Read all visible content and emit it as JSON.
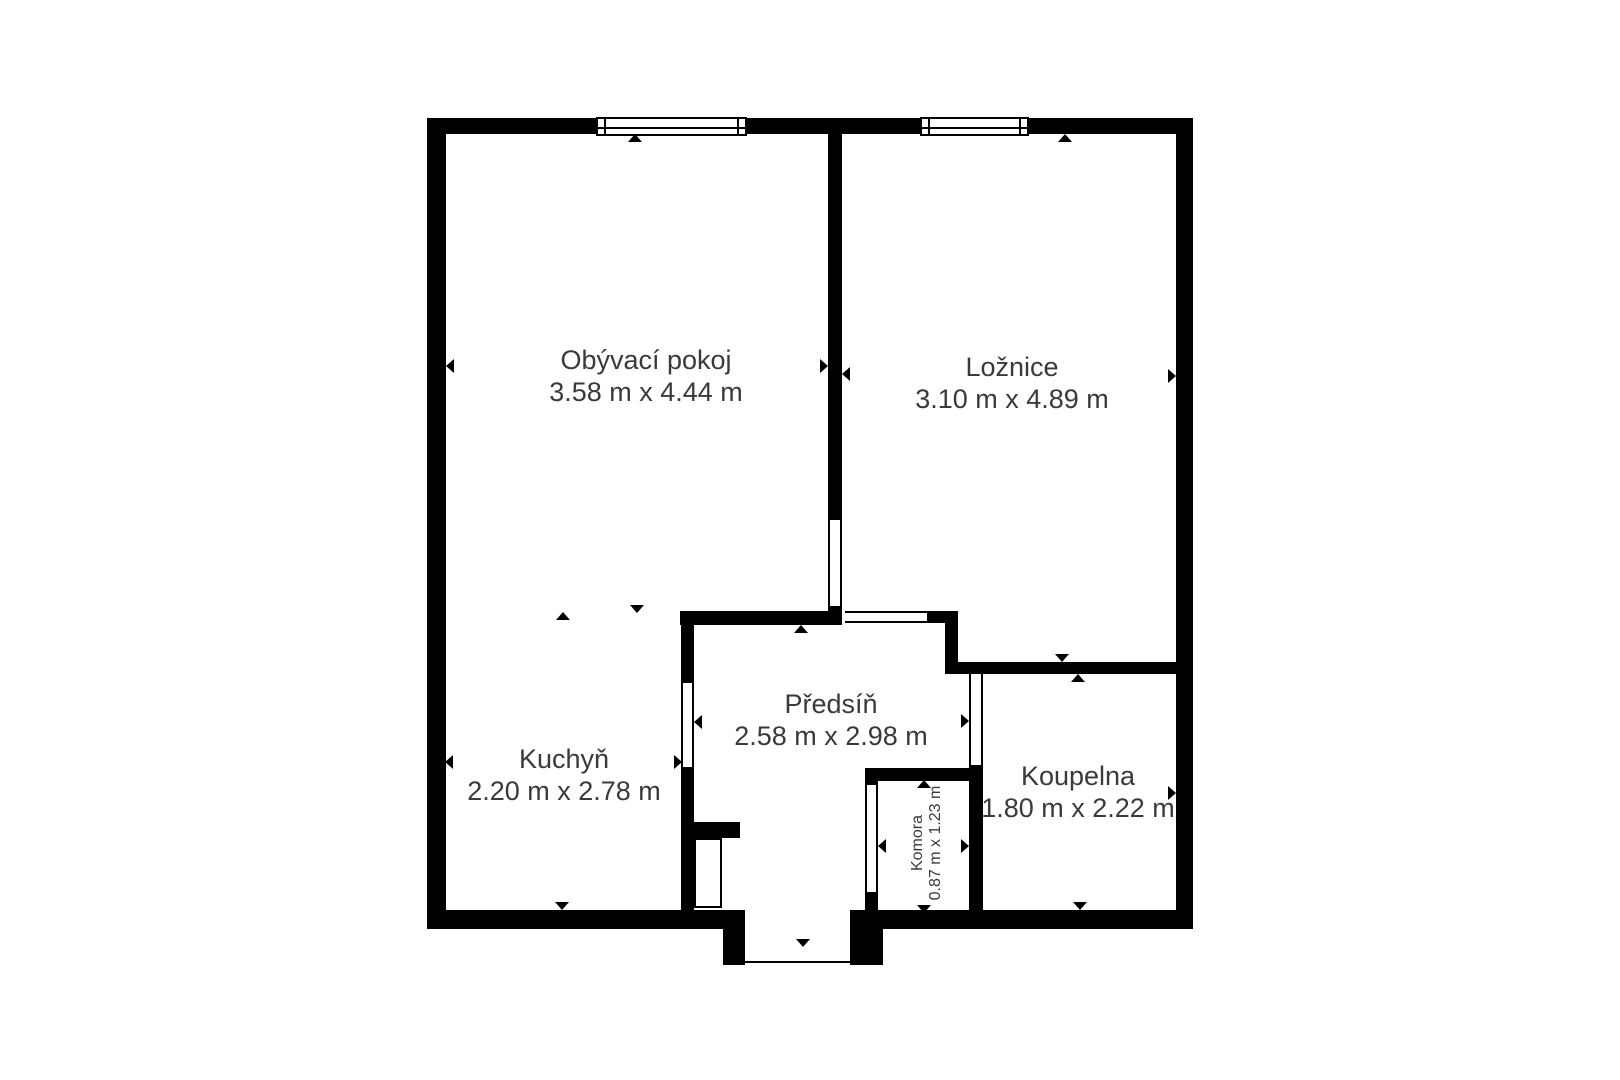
{
  "plan": {
    "type": "apartment-floor-plan",
    "colors": {
      "wall": "#000000",
      "text": "#3a3a3a",
      "background": "#ffffff"
    },
    "rooms": [
      {
        "name": "Obývací pokoj",
        "dimensions": "3.58 m x 4.44 m"
      },
      {
        "name": "Ložnice",
        "dimensions": "3.10 m x 4.89 m"
      },
      {
        "name": "Kuchyň",
        "dimensions": "2.20 m x 2.78 m"
      },
      {
        "name": "Předsíň",
        "dimensions": "2.58 m x 2.98 m"
      },
      {
        "name": "Koupelna",
        "dimensions": "1.80 m x 2.22 m"
      },
      {
        "name": "Komora",
        "dimensions": "0.87 m x 1.23 m"
      }
    ]
  }
}
